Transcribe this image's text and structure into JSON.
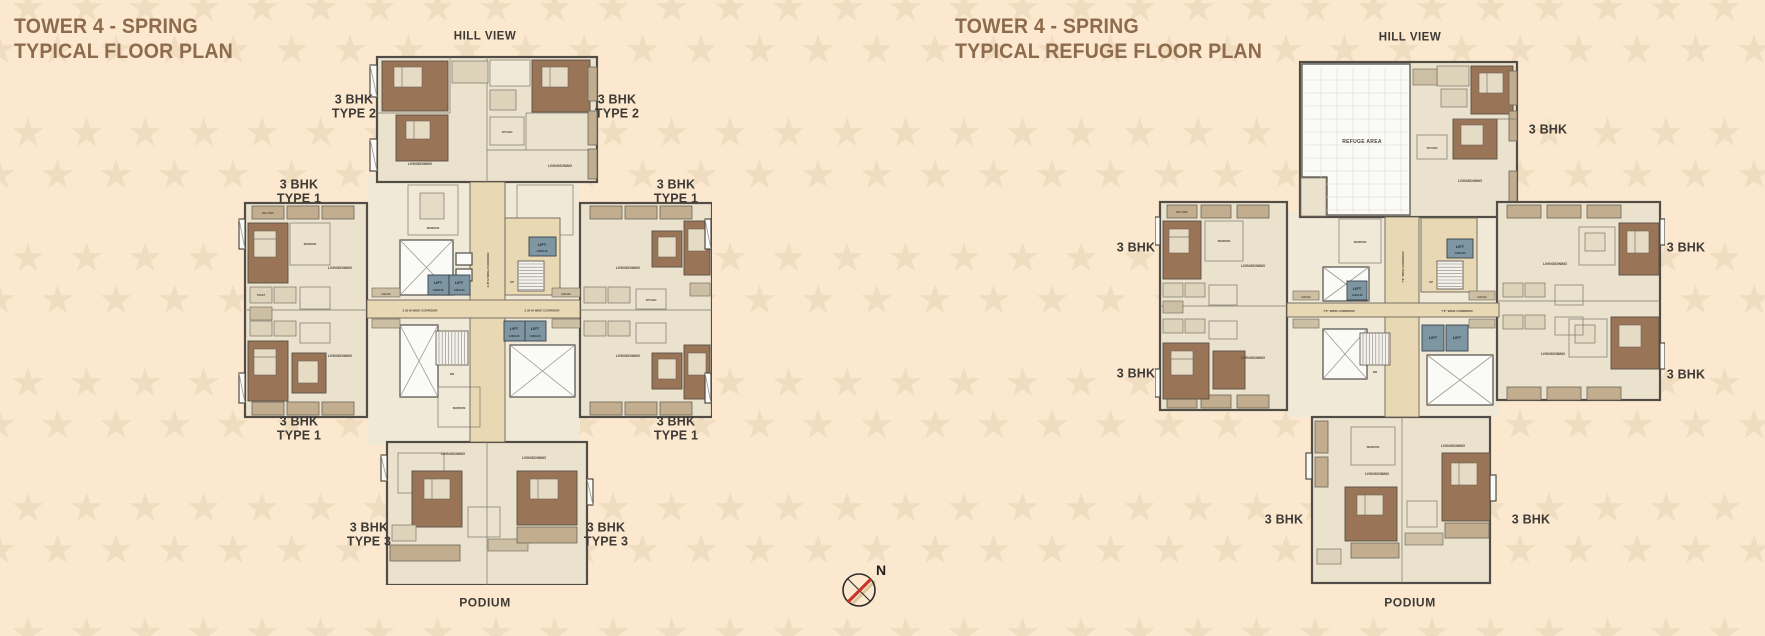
{
  "left_panel": {
    "title_line1": "TOWER 4 - SPRING",
    "title_line2": "TYPICAL FLOOR PLAN",
    "hill_view": "HILL VIEW",
    "podium": "PODIUM",
    "unit_labels": {
      "type1_line1": "3 BHK",
      "type1_line2": "TYPE 1",
      "type2_line1": "3 BHK",
      "type2_line2": "TYPE 2",
      "type3_line1": "3 BHK",
      "type3_line2": "TYPE 3"
    }
  },
  "right_panel": {
    "title_line1": "TOWER 4 - SPRING",
    "title_line2": "TYPICAL REFUGE FLOOR PLAN",
    "hill_view": "HILL VIEW",
    "podium": "PODIUM",
    "unit_label": "3 BHK",
    "refuge_area": "REFUGE AREA"
  },
  "room_labels": {
    "lift": "LIFT",
    "lift_size": "1.60X1.60",
    "living_dining": "LIVING/DINING",
    "bedroom": "BEDROOM",
    "kitchen": "KITCHEN",
    "toilet": "TOILET",
    "balcony": "BALCONY",
    "chajja": "CHAJJA",
    "corridor_left": "2.35 M WIDE CORRIDOR",
    "corridor_right": "7'6\" WIDE CORRIDOR",
    "up": "UP",
    "dn": "DN"
  },
  "compass": {
    "north": "N"
  },
  "colors": {
    "background": "#fbe8ce",
    "stars": "#f0dcbf",
    "title_brown": "#8e6b4c",
    "label_dark": "#3d3a36",
    "lift_blue": "#7e95a2",
    "compass_needle": "#c5352b"
  }
}
